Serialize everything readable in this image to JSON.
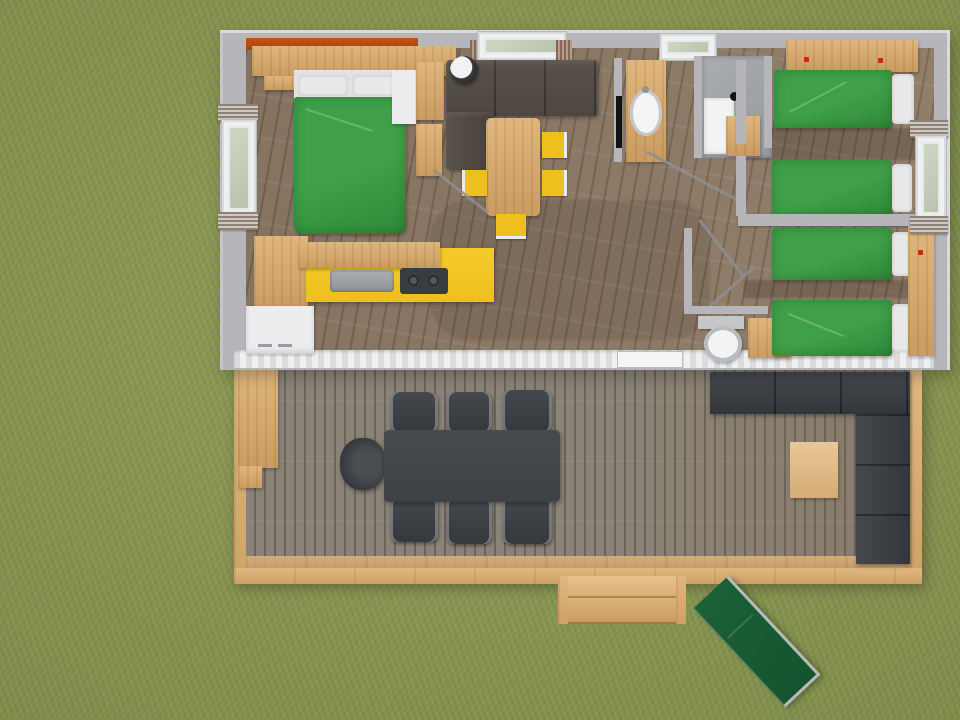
{
  "scene": {
    "title": "Top-down 3D floor plan render - mobile home with bedrooms, kitchen, bathroom and large wooden deck",
    "type": "architectural-render",
    "view": "bird's-eye"
  },
  "palette": {
    "grass": "#8a9750",
    "wall": "#b6b6ba",
    "wall-light": "#dadadd",
    "floor": "#8d7a66",
    "deck": "#8b8377",
    "frame-wood": "#dfb77f",
    "wood": "#e0b67e",
    "wood-dark": "#c99c61",
    "kitchen-yellow": "#eec01d",
    "bed-green": "#3fa047",
    "bed-green-dark": "#2e8a39",
    "pillow": "#e9e9ec",
    "sofa-brown": "#4e4741",
    "dark-furniture": "#3e4145",
    "white-goods": "#ececee",
    "orange": "#a6440f",
    "lounger": "#14532f",
    "lounger-frame": "#b2bdb8",
    "door-line": "#8e8e92",
    "red-dot": "#cc2a00"
  },
  "house": {
    "rooms": [
      {
        "name": "bedroom-master",
        "items": [
          "double-bed-green",
          "overhead-shelf",
          "orange-ledge",
          "wardrobe",
          "white-dresser",
          "bedside-shelf",
          "window-left-wall"
        ]
      },
      {
        "name": "living-dining",
        "items": [
          "l-shaped-brown-sofa",
          "round-planter",
          "dining-table",
          "yellow-chair x4",
          "wall-tv",
          "front-window-with-curtains"
        ]
      },
      {
        "name": "kitchen",
        "items": [
          "yellow-counter",
          "stainless-sink",
          "two-burner-hob",
          "upper-cabinets",
          "side-cabinet",
          "white-appliance"
        ]
      },
      {
        "name": "bathroom",
        "items": [
          "wood-vanity-with-oval-basin",
          "shower-enclosure",
          "shower-cabinet",
          "ceiling-spot",
          "window-over-shower"
        ]
      },
      {
        "name": "wc",
        "items": [
          "toilet",
          "wood-cabinet"
        ]
      },
      {
        "name": "bedroom-twin-top",
        "items": [
          "single-bed-green x2",
          "overhead-shelf-with-red-knobs"
        ]
      },
      {
        "name": "bedroom-twin-bottom",
        "items": [
          "single-bed-green x2",
          "tall-wardrobe",
          "window-right-wall"
        ]
      }
    ]
  },
  "deck": {
    "items": [
      "dark-dining-table",
      "dark-chair x6",
      "round-armchair",
      "l-shaped-outdoor-sofa",
      "wood-coffee-table",
      "storage-box",
      "entry-steps"
    ]
  },
  "garden": {
    "items": [
      "green-sun-lounger"
    ]
  }
}
